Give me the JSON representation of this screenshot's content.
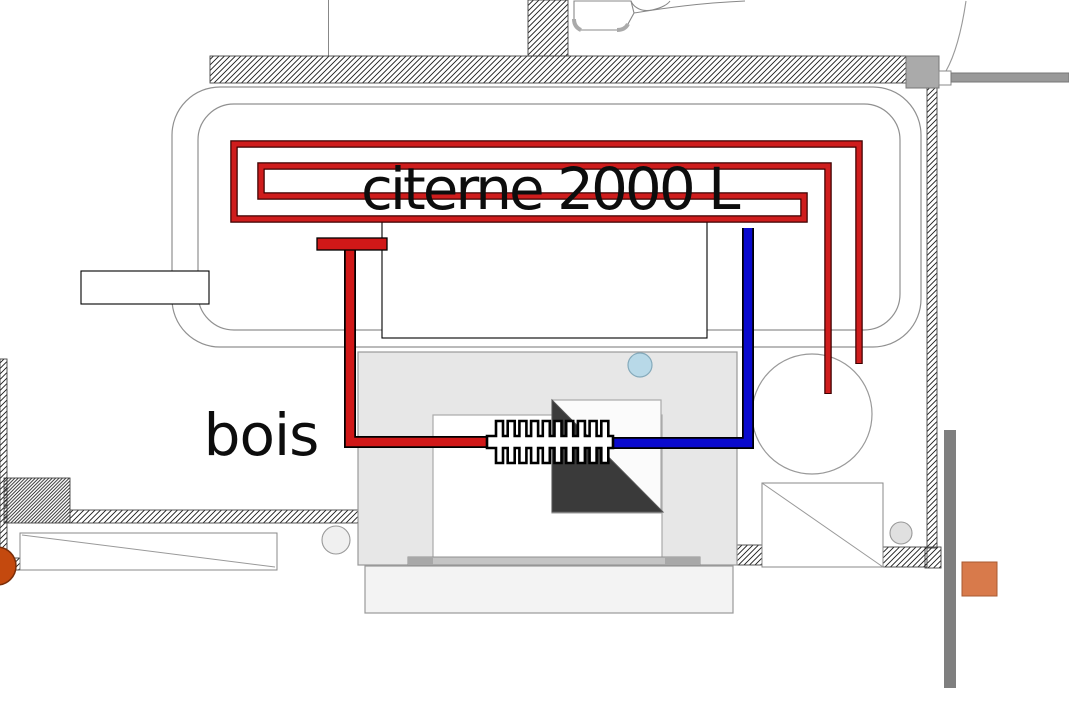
{
  "title": "heating system floor plan",
  "labels": {
    "tank": "citerne 2000 L",
    "wood": "bois"
  },
  "colors": {
    "hot_pipe": "#d01818",
    "cold_pipe": "#0a0acd",
    "pipe_outline": "#000000",
    "coil": "#cf1d1d",
    "coil_dark": "#3d0000",
    "tank_outline": "#909090",
    "wall_line": "#3a3a3a",
    "stove_fill": "#e7e7e7",
    "fire_triangle": "#3a3a3a",
    "port_circle": "#b8d9e8",
    "rust_circle": "#c4490e",
    "orange_square": "#d87a4b",
    "door_bar": "#999999",
    "side_bar": "#7f7f7f"
  }
}
